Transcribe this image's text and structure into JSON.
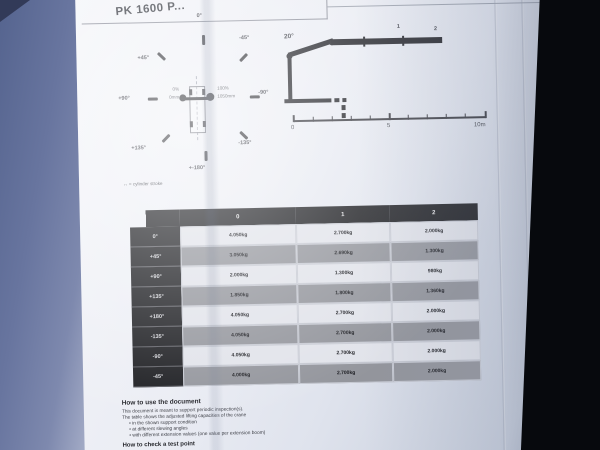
{
  "header": {
    "title": "PK 1600 P..."
  },
  "compass": {
    "labels": {
      "top": "0°",
      "top_right": "-45°",
      "right": "-90°",
      "bottom_right": "-135°",
      "bottom": "+-180°",
      "bottom_left": "+135°",
      "left": "+90°",
      "top_left": "+45°"
    },
    "stroke_min_pct": "0%",
    "stroke_min_mm": "0mm",
    "stroke_max_pct": "100%",
    "stroke_max_mm": "1050mm",
    "legend": "↔ = cylinder stroke"
  },
  "crane_diagram": {
    "boom_angle": "20°",
    "extension_labels": [
      "1",
      "2"
    ],
    "scale": {
      "start": "0",
      "mid": "5",
      "end": "10m"
    }
  },
  "table": {
    "columns": [
      "0",
      "1",
      "2"
    ],
    "rows": [
      {
        "angle": "0°",
        "values": [
          "4.050kg",
          "2.700kg",
          "2.000kg"
        ]
      },
      {
        "angle": "+45°",
        "values": [
          "3.050kg",
          "2.690kg",
          "1.300kg"
        ]
      },
      {
        "angle": "+90°",
        "values": [
          "2.000kg",
          "1.300kg",
          "980kg"
        ]
      },
      {
        "angle": "+135°",
        "values": [
          "1.850kg",
          "1.800kg",
          "1.360kg"
        ]
      },
      {
        "angle": "+180°",
        "values": [
          "4.050kg",
          "2.700kg",
          "2.000kg"
        ]
      },
      {
        "angle": "-135°",
        "values": [
          "4.050kg",
          "2.700kg",
          "2.000kg"
        ]
      },
      {
        "angle": "-90°",
        "values": [
          "4.050kg",
          "2.700kg",
          "2.000kg"
        ]
      },
      {
        "angle": "-45°",
        "values": [
          "4.000kg",
          "2.700kg",
          "2.000kg"
        ]
      }
    ]
  },
  "instructions": {
    "heading": "How to use the document",
    "line1": "This document is meant to support periodic inspection(s).",
    "line2": "The table shows the adjusted lifting capacities of the crane",
    "bullets": [
      "in the shown support condition",
      "at different slewing angles",
      "with different extension values (one value per extension boom)"
    ],
    "heading2": "How to check a test point"
  },
  "colors": {
    "paper": "#e9ebf3",
    "table_header": "#1b1c20",
    "row_light": "#e1e3ea",
    "row_dark": "#93959c",
    "backdrop_left": "#68759f",
    "backdrop_right": "#07090d"
  }
}
